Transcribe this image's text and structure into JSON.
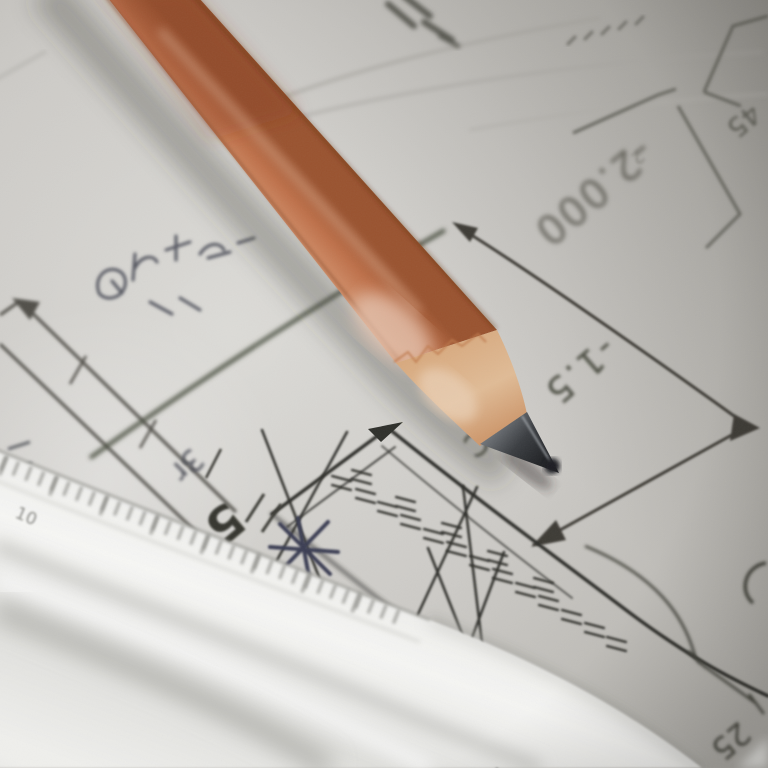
{
  "photo": {
    "labels": {
      "dim_neg2000": "-2.000",
      "dim_neg15": "-1.5",
      "letter_c": "C",
      "corner_45": "45",
      "small_2": "2",
      "dim_5": "5",
      "dim_25": "25",
      "handwritten_3r": "3r",
      "ruler_10": "10"
    },
    "colors": {
      "pencil_body": "#c97f58",
      "pencil_highlight": "#e9c3a9",
      "pencil_wood": "#d8a87c",
      "graphite": "#2b2d30",
      "paper": "#cfcdc9",
      "drawing_ink": "#3a3b34",
      "ruler_white": "#f2f2f0",
      "handwriting": "#4c4e57"
    }
  }
}
